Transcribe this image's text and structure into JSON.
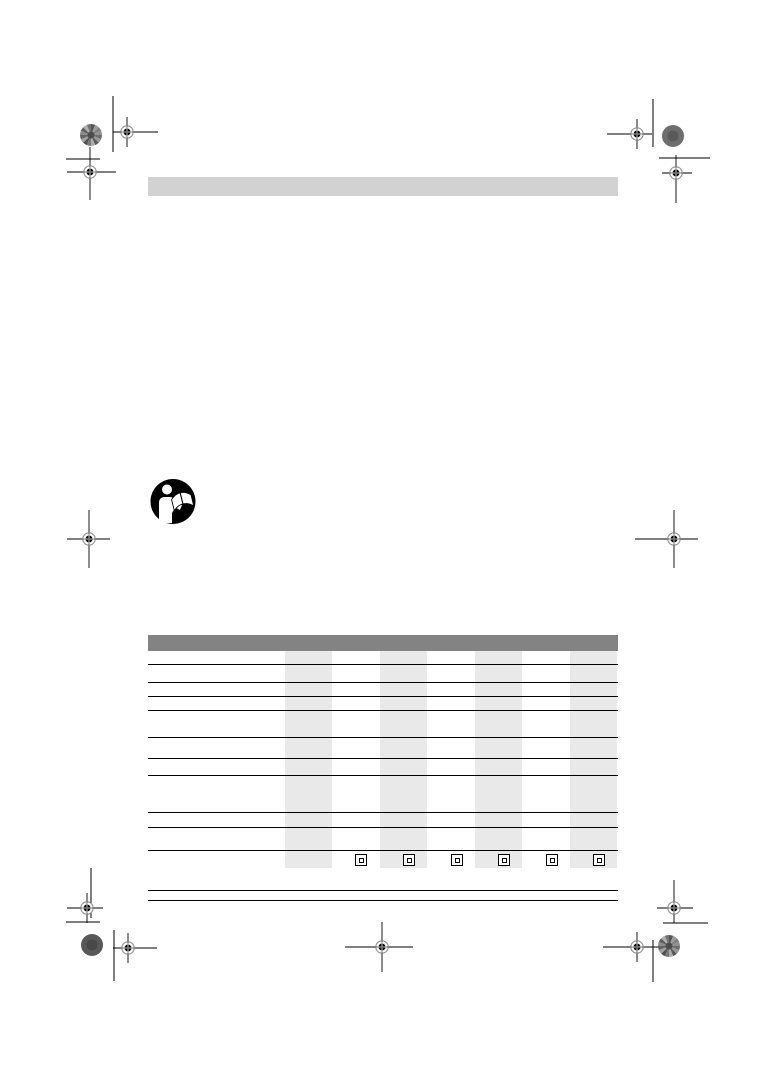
{
  "page": {
    "width": 765,
    "height": 1082,
    "background": "#ffffff",
    "kind": "pre-press instruction manual page",
    "note": "No printed text visible: gray title bar, read-the-manual pictogram, empty specification table with shaded model columns and protection-class symbols, printer registration and trim marks"
  },
  "colors": {
    "top_bar": "#d2d2d2",
    "table_header_bar": "#838383",
    "column_band": "#e9e9e9",
    "grid_line": "#000000",
    "mark_line": "#000000",
    "mark_ring": "#8f8f8f",
    "pictogram_black": "#000000",
    "pictogram_white": "#ffffff"
  },
  "top_bar": {
    "x": 148,
    "y": 177,
    "w": 470,
    "h": 19
  },
  "pictogram": {
    "x": 150,
    "y": 478,
    "w": 46,
    "h": 47,
    "meaning": "read-instruction-manual"
  },
  "table": {
    "x": 148,
    "w": 470,
    "header_bar": {
      "y": 635,
      "h": 16
    },
    "band_top": 651,
    "band_bottom": 868,
    "band_w": 47,
    "band_x": [
      285,
      380,
      475,
      570
    ],
    "row_line_y": [
      664,
      682,
      696,
      710,
      737,
      758,
      775,
      812,
      827,
      850
    ],
    "row_line_thickness": 1,
    "insulation_icons": {
      "y": 854,
      "size": 12,
      "x": [
        355,
        403,
        451,
        498,
        546,
        593
      ],
      "meaning": "protection-class-II-double-square"
    }
  },
  "footer_lines": {
    "x": 148,
    "w": 470,
    "y": [
      890,
      900
    ],
    "thickness": 1
  },
  "printer_marks": {
    "registration_marks": [
      {
        "pos": "top-left-outer",
        "cx": 127,
        "cy": 132,
        "h": [
          113,
          158
        ],
        "v": [
          117,
          147
        ]
      },
      {
        "pos": "top-left-inner",
        "cx": 90,
        "cy": 172,
        "h": [
          67,
          116
        ],
        "v": [
          147,
          200
        ]
      },
      {
        "pos": "top-right-outer",
        "cx": 637,
        "cy": 134,
        "h": [
          607,
          652
        ],
        "v": [
          119,
          149
        ]
      },
      {
        "pos": "top-right-inner",
        "cx": 676,
        "cy": 173,
        "h": [
          662,
          692
        ],
        "v": [
          155,
          203
        ]
      },
      {
        "pos": "middle-left",
        "cx": 89,
        "cy": 539,
        "h": [
          67,
          110
        ],
        "v": [
          510,
          568
        ]
      },
      {
        "pos": "middle-right",
        "cx": 674,
        "cy": 539,
        "h": [
          635,
          698
        ],
        "v": [
          510,
          568
        ]
      },
      {
        "pos": "bottom-left-outer",
        "cx": 87,
        "cy": 908,
        "h": [
          67,
          103
        ],
        "v": [
          893,
          923
        ]
      },
      {
        "pos": "bottom-left-inner",
        "cx": 128,
        "cy": 948,
        "h": [
          113,
          157
        ],
        "v": [
          933,
          963
        ]
      },
      {
        "pos": "bottom-center",
        "cx": 382,
        "cy": 947,
        "h": [
          345,
          413
        ],
        "v": [
          922,
          972
        ]
      },
      {
        "pos": "bottom-right-outer",
        "cx": 674,
        "cy": 908,
        "h": [
          657,
          693
        ],
        "v": [
          880,
          923
        ]
      },
      {
        "pos": "bottom-right-inner",
        "cx": 637,
        "cy": 947,
        "h": [
          603,
          667
        ],
        "v": [
          932,
          962
        ]
      }
    ],
    "trim_lines": [
      {
        "pos": "top-left-vertical",
        "x1": 113,
        "y1": 96,
        "x2": 113,
        "y2": 152
      },
      {
        "pos": "top-left-horizontal",
        "x1": 66,
        "y1": 159,
        "x2": 100,
        "y2": 159
      },
      {
        "pos": "top-right-vertical",
        "x1": 653,
        "y1": 99,
        "x2": 653,
        "y2": 147
      },
      {
        "pos": "top-right-horizontal",
        "x1": 659,
        "y1": 158,
        "x2": 710,
        "y2": 158
      },
      {
        "pos": "bottom-left-vertical",
        "x1": 91,
        "y1": 868,
        "x2": 91,
        "y2": 918
      },
      {
        "pos": "bottom-left-horizontal",
        "x1": 66,
        "y1": 922,
        "x2": 100,
        "y2": 922
      },
      {
        "pos": "bottom-left-inner-vertical",
        "x1": 114,
        "y1": 930,
        "x2": 114,
        "y2": 981
      },
      {
        "pos": "bottom-right-vertical",
        "x1": 653,
        "y1": 940,
        "x2": 653,
        "y2": 982
      },
      {
        "pos": "bottom-right-horizontal",
        "x1": 663,
        "y1": 923,
        "x2": 708,
        "y2": 923
      }
    ],
    "color_patches": [
      {
        "pos": "top-left",
        "cx": 91,
        "cy": 135,
        "r": 11,
        "style": "textured"
      },
      {
        "pos": "top-right",
        "cx": 673,
        "cy": 136,
        "r": 11,
        "style": "solid",
        "color": "#6d6d6d"
      },
      {
        "pos": "bottom-left",
        "cx": 92,
        "cy": 945,
        "r": 11,
        "style": "solid",
        "color": "#585858"
      },
      {
        "pos": "bottom-right",
        "cx": 669,
        "cy": 946,
        "r": 11,
        "style": "textured"
      }
    ]
  }
}
